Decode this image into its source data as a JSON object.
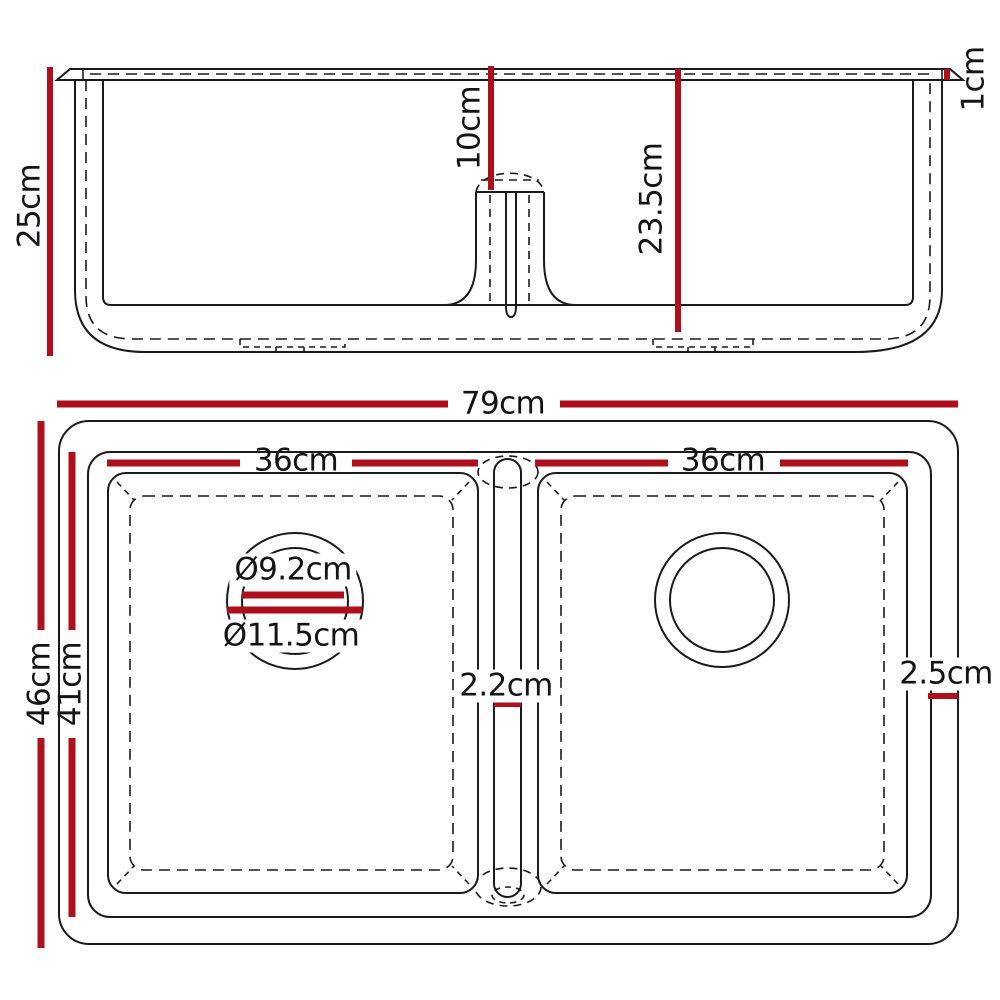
{
  "colors": {
    "dimension_red": "#ad0f1c",
    "line_black": "#1a1a1a",
    "background": "#ffffff"
  },
  "side_view": {
    "overall_height": "25cm",
    "divider_top_offset": "10cm",
    "bowl_depth": "23.5cm",
    "rim_thickness": "1cm"
  },
  "top_view": {
    "overall_width": "79cm",
    "left_bowl_width": "36cm",
    "right_bowl_width": "36cm",
    "overall_depth": "46cm",
    "inner_depth": "41cm",
    "drain_inner_diameter": "Ø9.2cm",
    "drain_outer_diameter": "Ø11.5cm",
    "divider_width": "2.2cm",
    "edge_width": "2.5cm"
  }
}
